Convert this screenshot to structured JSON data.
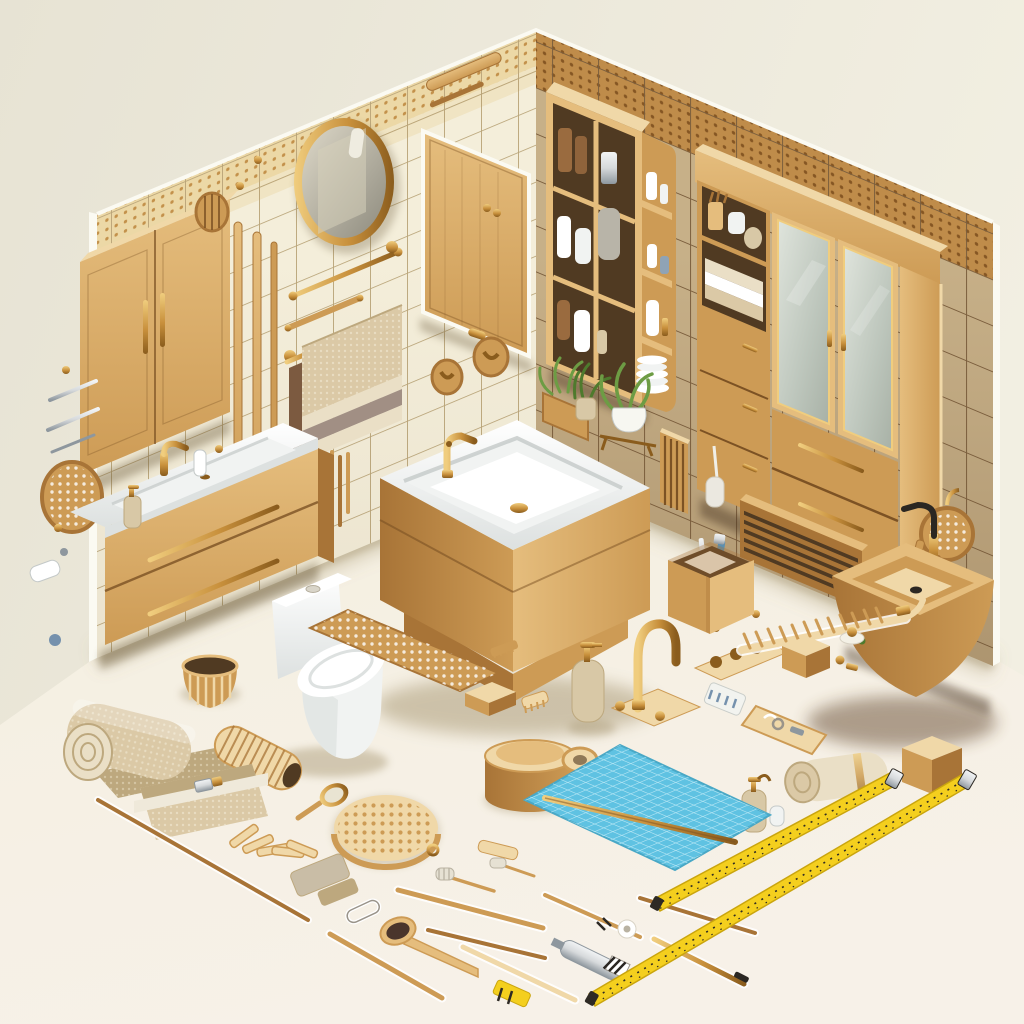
{
  "scene": {
    "title": "Isometric bathroom corner with wooden furniture, fixtures and flat-lay accessories",
    "objects": [
      "cream tiled left wall with dotted border",
      "tan tiled right wall with dotted border",
      "wooden two-door wall cabinet",
      "round brass-framed mirror",
      "wooden wall panel",
      "towel rails with beige hanging towel",
      "wooden wall hooks",
      "rattan disc",
      "white vanity sink on wooden drawer unit",
      "open wooden shelf with toiletries and plates",
      "hanging plants",
      "large cabinet with frosted glass doors and drawers",
      "wooden radiator",
      "rattan shower head",
      "wooden wall-hung basin with faucet",
      "freestanding bathtub with wood skirt and brass faucet",
      "white one-piece toilet",
      "bamboo mat",
      "wooden soap block",
      "woven basket",
      "rolled beige towel",
      "fabric pouch with strap",
      "ribbed wooden roller",
      "clothespins",
      "round wooden bristle brush",
      "spoon brush",
      "wooden sticks and brushes",
      "brass gooseneck faucet",
      "brass tap handle set",
      "soap dispenser bottles",
      "wooden canister",
      "tape roll",
      "blue grid bath mat with wooden rod",
      "wooden box with razors",
      "wooden rung rack",
      "small wooden box",
      "wooden tray with metal parts",
      "rolled fiber mat",
      "wooden cube",
      "two yellow measuring tapes",
      "caulking tool",
      "gold pen rod"
    ]
  },
  "palette": {
    "bg_top": "#e7e3d4",
    "bg_right": "#f2efe2",
    "floor": "#f4efe0",
    "floor_warm": "#f7f1e8",
    "floor_shadow": "#9c8a62",
    "tile_left": "#f4eeda",
    "grout_left": "#b9a478",
    "border_left": "#ecd8a6",
    "border_left_dot": "#c3914b",
    "tile_right": "#c7b088",
    "grout_right": "#7c5f3e",
    "border_right": "#bf8c4a",
    "border_right_dot": "#855623",
    "wall_shade": "#7c5f3e",
    "wall_edge": "#fbfaf2",
    "wood_pale": "#f0d8a8",
    "wood_light": "#e5bd7d",
    "wood_mid": "#cd9b55",
    "wood_dark": "#a87437",
    "wood_deep": "#7c5224",
    "interior": "#503a22",
    "brass_light": "#f0cd7e",
    "brass": "#c8903c",
    "brass_dark": "#8a5c1d",
    "ceramic": "#ffffff",
    "ceramic_soft": "#f1f3f2",
    "ceramic_shade": "#dde1e0",
    "ceramic_dark": "#c4c9c8",
    "glass_light": "#dfe4dc",
    "glass": "#bdc6bc",
    "mirror_light": "#ddd8c8",
    "mirror_dark": "#8e8b7e",
    "towel": "#dbc9a6",
    "towel_light": "#eadfc6",
    "towel_dark": "#bda87e",
    "towel_stripe": "#a18f84",
    "towel_brown": "#7c5a40",
    "plant": "#6d9c44",
    "plant_dark": "#4e7a2d",
    "pot_white": "#f7f7f1",
    "blue_mat": "#5fc2e2",
    "blue_grid": "#b5e6f4",
    "tape_yellow": "#f4cf1e",
    "tape_dark": "#2e2a24",
    "metal": "#d6d9db",
    "metal_dark": "#8e979e",
    "black": "#2b2722",
    "amber": "#9a6b3f",
    "cream_bottle": "#d8c8a6",
    "taupe": "#c9bda6",
    "razor_blue": "#5b8fb0",
    "accessory_blue": "#7591ad"
  }
}
